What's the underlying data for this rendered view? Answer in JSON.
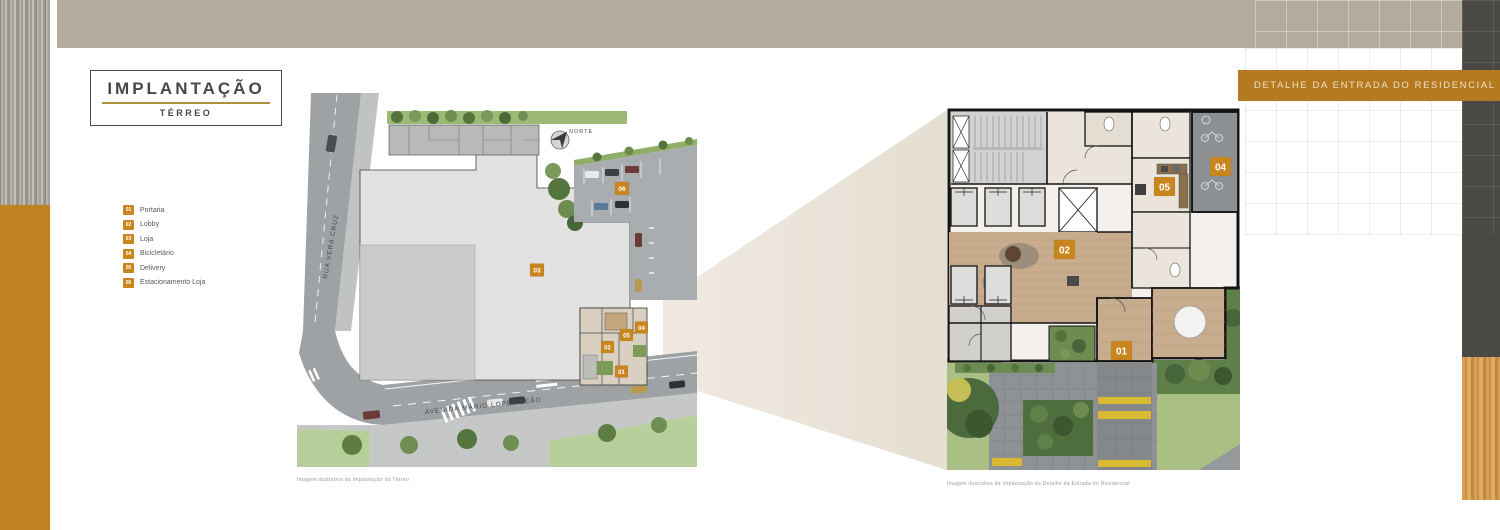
{
  "title_box": {
    "title": "IMPLANTAÇÃO",
    "subtitle": "TÉRREO"
  },
  "banner": {
    "label": "DETALHE DA ENTRADA DO RESIDENCIAL"
  },
  "legend": {
    "items": [
      {
        "num": "01",
        "label": "Portaria"
      },
      {
        "num": "02",
        "label": "Lobby"
      },
      {
        "num": "03",
        "label": "Loja"
      },
      {
        "num": "04",
        "label": "Bicicletário"
      },
      {
        "num": "05",
        "label": "Delivery"
      },
      {
        "num": "06",
        "label": "Estacionamento Loja"
      }
    ]
  },
  "site_plan": {
    "streets": {
      "vertical": "RUA VERA CRUZ",
      "horizontal": "AVENIDA MÁRIO LOPES LEÃO"
    },
    "compass": "NORTE",
    "caption": "Imagem ilustrativa da Implantação do Térreo",
    "markers": {
      "m01": "01",
      "m02": "02",
      "m03": "03",
      "m04": "04",
      "m05": "05",
      "m06": "06"
    }
  },
  "detail_plan": {
    "caption": "Imagem ilustrativa da Implantação do Detalhe da Entrada do Residencial",
    "markers": {
      "m01": "01",
      "m02": "02",
      "m04": "04",
      "m05": "05"
    }
  },
  "colors": {
    "accent_orange": "#C08121",
    "banner_bg": "#B5791F",
    "top_bar_beige": "#B3AB9B",
    "side_dark_gray": "#4B4946",
    "wood": "#D29A55",
    "marker": "#C9861E"
  }
}
